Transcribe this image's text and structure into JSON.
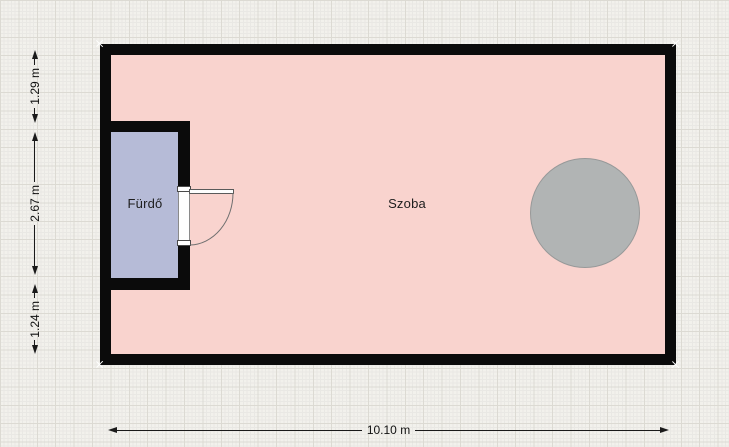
{
  "app": {
    "view": "floor-plan-canvas"
  },
  "rooms": [
    {
      "name": "Szoba",
      "fill": "#f9d3ce"
    },
    {
      "name": "Fürdő",
      "fill": "#b6bbd7"
    }
  ],
  "objects": [
    {
      "name": "round-table",
      "shape": "circle",
      "fill": "#b1b4b4"
    }
  ],
  "dimensions": {
    "left": [
      {
        "label": "1.29 m"
      },
      {
        "label": "2.67 m"
      },
      {
        "label": "1.24 m"
      }
    ],
    "bottom": {
      "label": "10.10 m"
    }
  },
  "colors": {
    "wall": "#0b0b0b",
    "grid_background": "#f2f1ec",
    "grid_minor_line": "#e9e8e4",
    "grid_major_line": "#dcdad3",
    "dimension_line": "#1a1a1a"
  }
}
